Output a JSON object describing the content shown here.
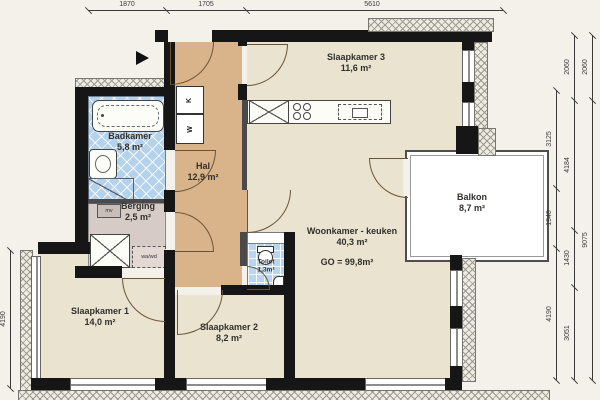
{
  "rooms": [
    {
      "id": "slaapkamer3",
      "name": "Slaapkamer 3",
      "area": "11,6 m²"
    },
    {
      "id": "badkamer",
      "name": "Badkamer",
      "area": "5,8 m²"
    },
    {
      "id": "hal",
      "name": "Hal",
      "area": "12,9 m²"
    },
    {
      "id": "berging",
      "name": "Berging",
      "area": "2,5 m²"
    },
    {
      "id": "toilet",
      "name": "Toilet",
      "area": "1,3m²"
    },
    {
      "id": "woonkamer",
      "name": "Woonkamer - keuken",
      "area": "40,3 m²",
      "extra": "GO = 99,8m²"
    },
    {
      "id": "balkon",
      "name": "Balkon",
      "area": "8,7 m²"
    },
    {
      "id": "slaapkamer1",
      "name": "Slaapkamer 1",
      "area": "14,0 m²"
    },
    {
      "id": "slaapkamer2",
      "name": "Slaapkamer 2",
      "area": "8,2 m²"
    }
  ],
  "fixtures": {
    "closet_k": "K",
    "closet_w": "W",
    "vent": "mv",
    "washer": "wa/wd"
  },
  "dimensions": {
    "top": [
      "1870",
      "1705",
      "5610"
    ],
    "left": [
      "4190"
    ],
    "right_col1": [
      "3125",
      "1940",
      "4190"
    ],
    "right_col2": [
      "2060",
      "4184",
      "1430",
      "3051"
    ],
    "right_col3": [
      "2060",
      "9075"
    ]
  },
  "colors": {
    "wall": "#161616",
    "floor_rooms": "#e9e3d0",
    "floor_hall": "#d9b38a",
    "floor_storage": "#d7cbc7",
    "tiles": "#b5d2ec",
    "background": "#f4f1ea"
  }
}
